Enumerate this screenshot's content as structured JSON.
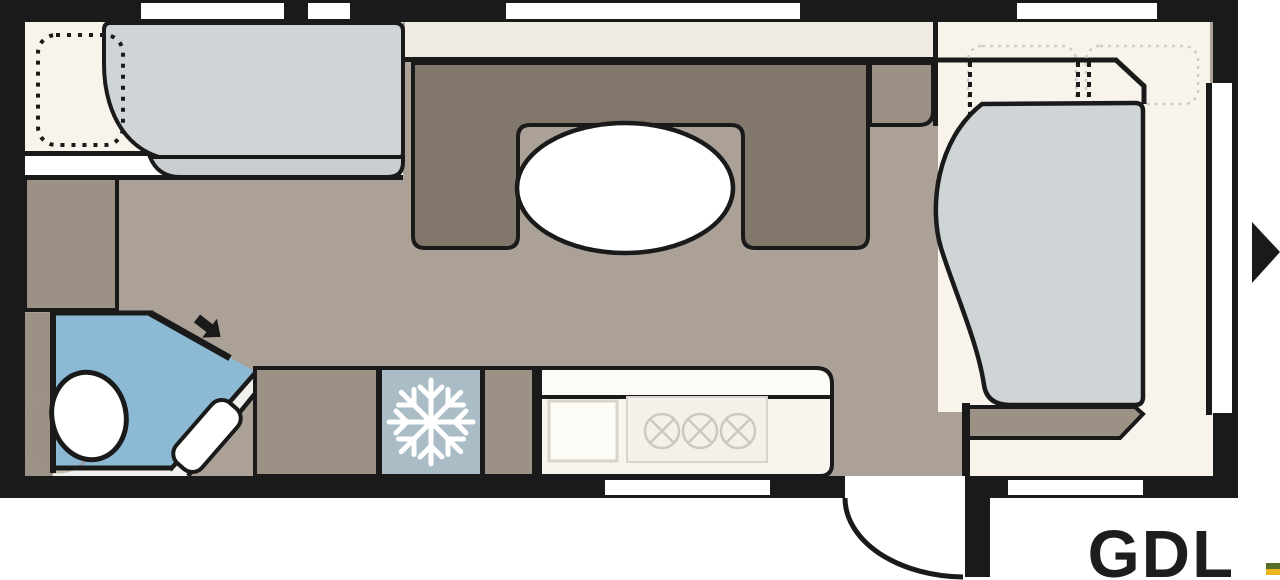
{
  "plan": {
    "model_label": "GDL",
    "colors": {
      "page": "#ffffff",
      "wall": "#1a1a1a",
      "floor": "#aca197",
      "sofa": "#82776b",
      "cabinet": "#9b9184",
      "bed": "#cfd4d7",
      "bedband": "#c8cdd1",
      "bath": "#8cbad4",
      "fridge": "#aabcc6",
      "cream": "#f8f4ec",
      "shelf": "#f0ebe2",
      "counter": "#f8f5ee",
      "counterwhite": "#fdfbf6",
      "white": "#ffffff",
      "faint": "#d9d5cc",
      "faintfill": "#f4f1ea",
      "text": "#1d1d1b",
      "logogreen": "#56702a",
      "logoyellow": "#eab51e"
    },
    "icons": {
      "fridge_icon": "snowflake-icon",
      "entry_direction_icon": "right-triangle-arrow-icon",
      "bathroom_door_icon": "down-right-arrow-icon"
    }
  }
}
